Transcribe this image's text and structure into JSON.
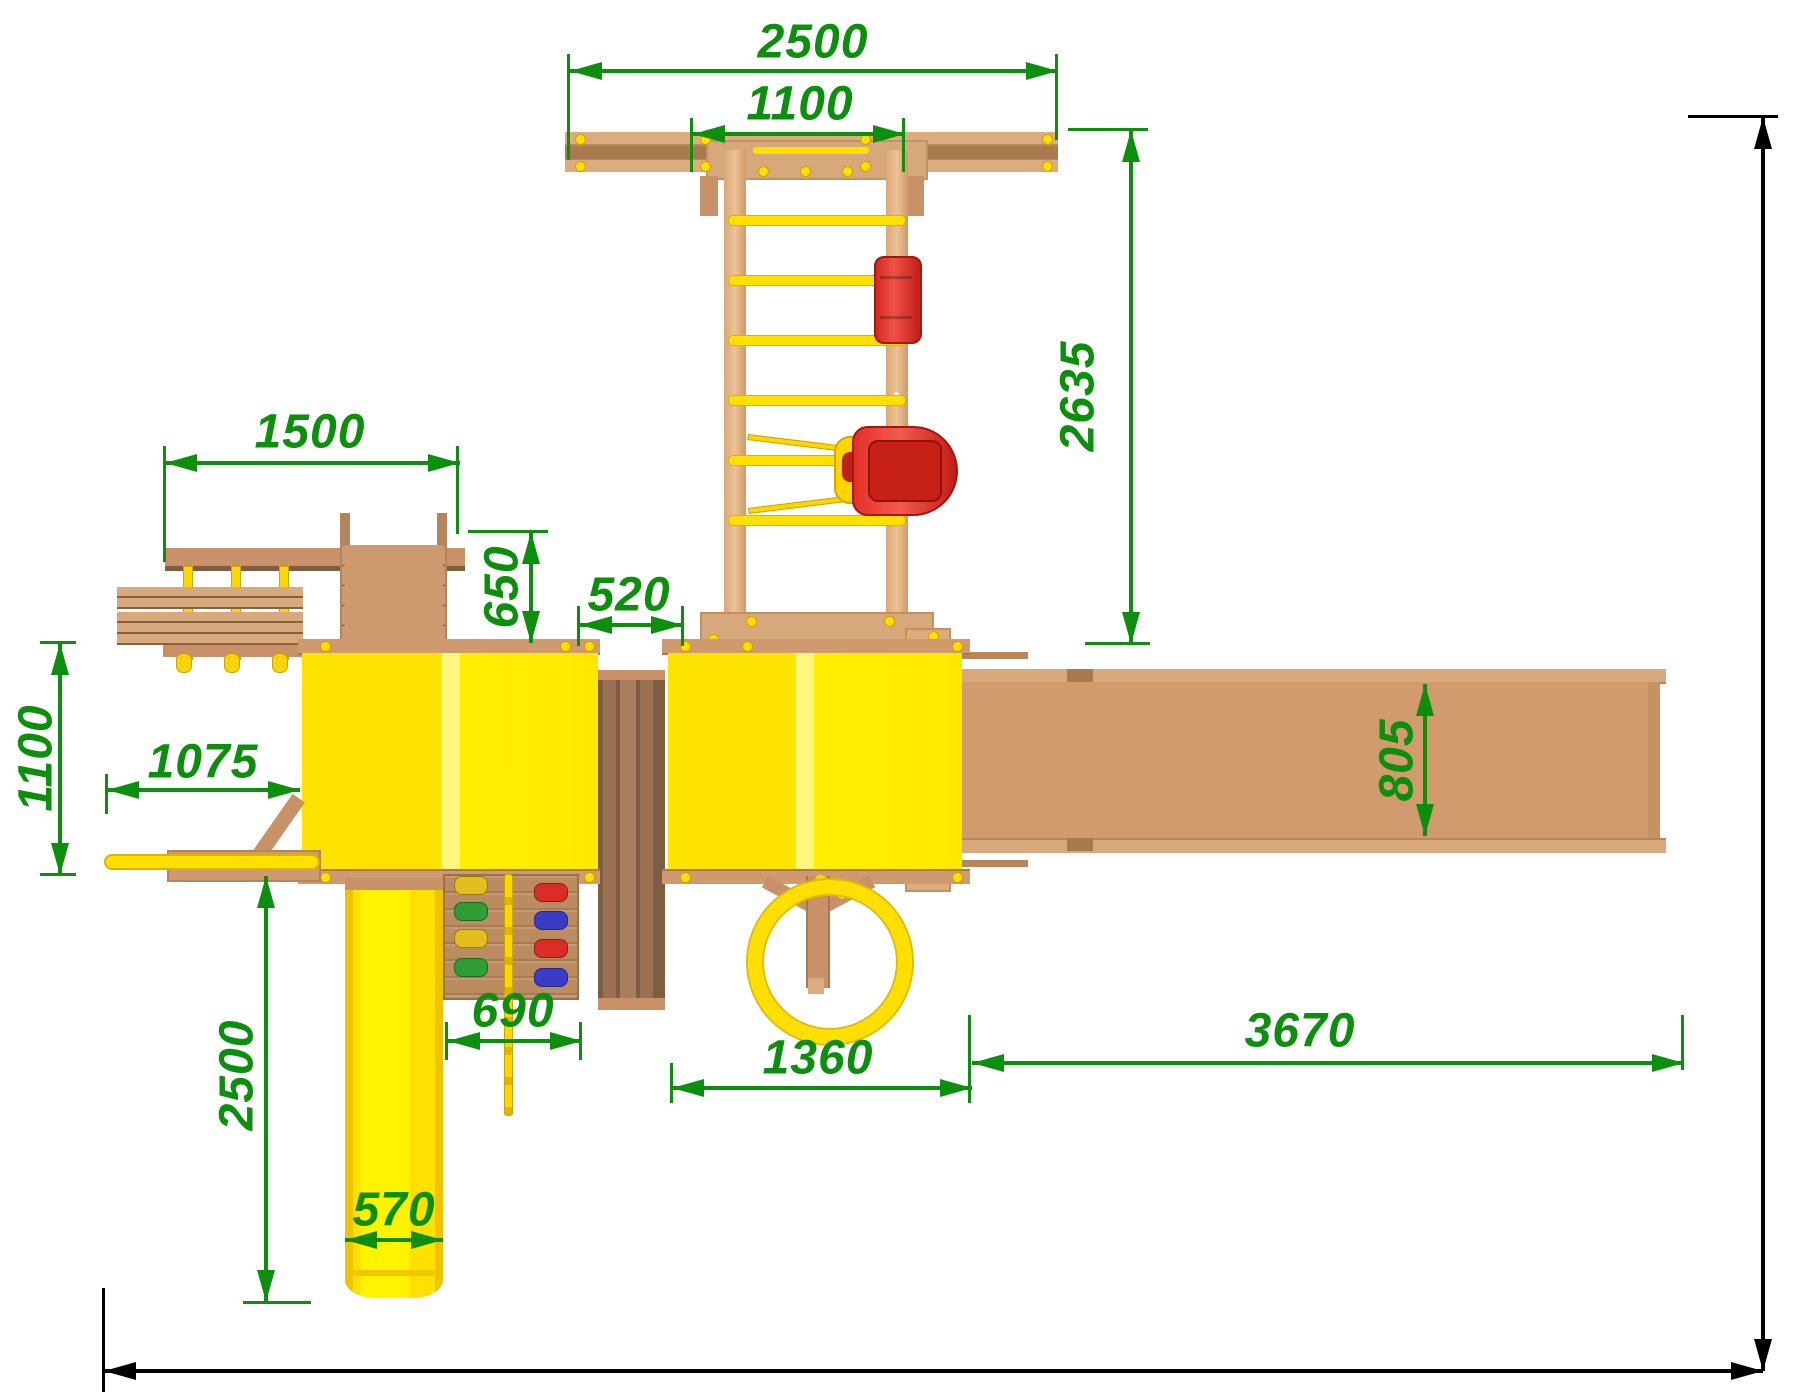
{
  "drawing": {
    "kind": "playground-top-view-plan",
    "dimension_labels": {
      "top_span": "2500",
      "top_inner_span": "1100",
      "swing_extent": "2635",
      "bench_span": "1500",
      "ramp_offset": "650",
      "bridge_gap": "520",
      "left_depth": "1100",
      "pole_reach": "1075",
      "slide_extent": "2500",
      "climb_wall_width": "690",
      "slide_width": "570",
      "tower_span": "1360",
      "walkway_span": "3670",
      "walkway_width": "805",
      "overall_depth": "6235",
      "overall_width": "7985"
    },
    "colors": {
      "dimension_green": "#0c8f0c",
      "dimension_black": "#000000",
      "platform_yellow": "#ffe800",
      "slide_yellow": "#ffdf00",
      "wood_light": "#dcab7e",
      "wood_mid": "#c99167",
      "wood_dark": "#8a5f3e",
      "swing_seat_red": "#e23228"
    }
  }
}
